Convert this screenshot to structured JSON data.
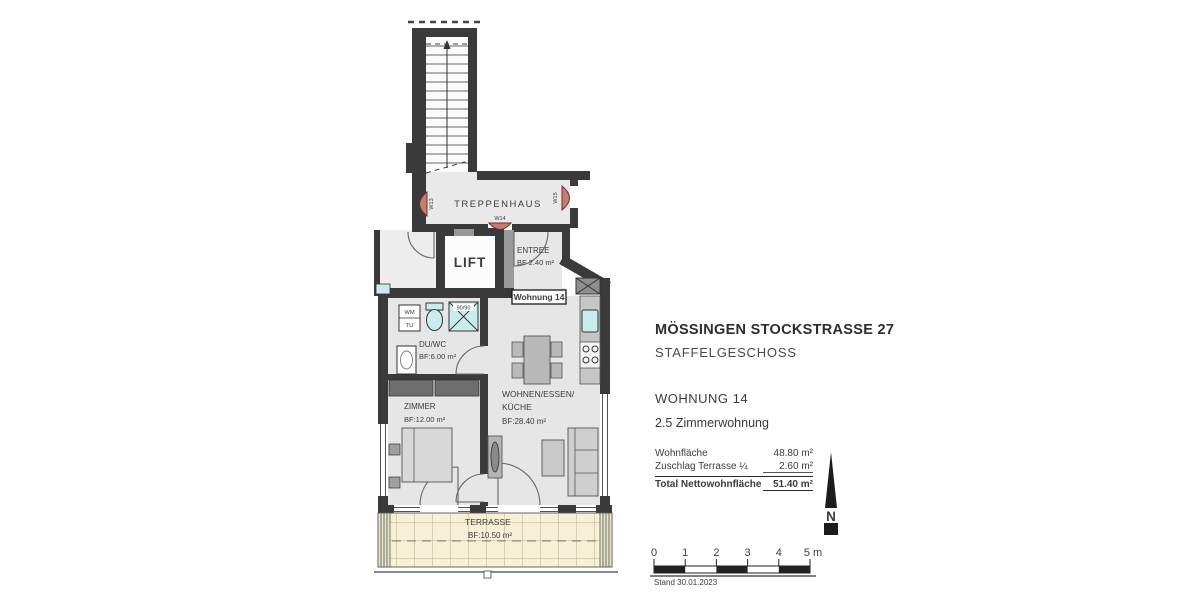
{
  "plan": {
    "stairwell_label": "TREPPENHAUS",
    "lift_label": "LIFT",
    "unit_tag": "Wohnung 14",
    "doors": {
      "w13": "W13",
      "w14": "W14",
      "w15": "W15"
    },
    "rooms": {
      "entree": {
        "name": "ENTREE",
        "area": "BF 2.40 m²"
      },
      "du_wc": {
        "name": "DU/WC",
        "area": "BF:6.00 m²"
      },
      "zimmer": {
        "name": "ZIMMER",
        "area": "BF:12.00 m²"
      },
      "wohnen": {
        "name1": "WOHNEN/ESSEN/",
        "name2": "KÜCHE",
        "area": "BF:28.40 m²"
      },
      "terrasse": {
        "name": "TERRASSE",
        "area": "BF:10.50 m²"
      }
    },
    "fixtures": {
      "washer": "WM",
      "dryer": "TU",
      "shower_size": "90/90"
    }
  },
  "info": {
    "title": "MÖSSINGEN STOCKSTRASSE 27",
    "floor": "STAFFELGESCHOSS",
    "unit": "WOHNUNG 14",
    "unit_type": "2.5 Zimmerwohnung",
    "area_table": {
      "rows": [
        {
          "label": "Wohnfläche",
          "value": "48.80 m²"
        },
        {
          "label": "Zuschlag Terrasse ¼",
          "value": "2.60 m²"
        }
      ],
      "total_label": "Total Nettowohnfläche",
      "total_value": "51.40 m²"
    }
  },
  "north_label": "N",
  "scale_bar": {
    "tick_labels": [
      "0",
      "1",
      "2",
      "3",
      "4",
      "5 m"
    ],
    "date": "Stand 30.01.2023"
  },
  "colors": {
    "wall": "#3a3a3a",
    "floor": "#e6e6e6",
    "terrace": "#f7f0d6",
    "fixture": "#c9ecec",
    "door_arc": "#9c4a3c"
  }
}
